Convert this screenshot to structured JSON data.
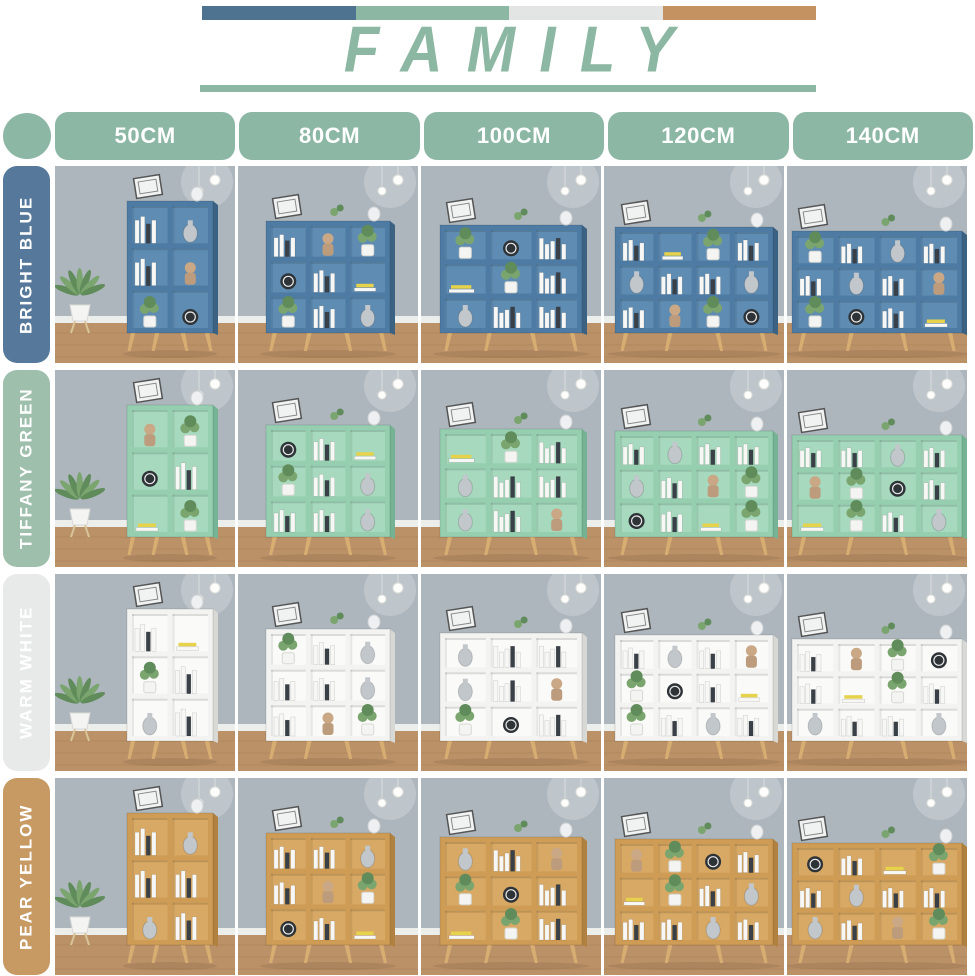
{
  "banner": {
    "title": "FAMILY",
    "title_color": "#8cb7a2",
    "underline_color": "#8cb7a2",
    "bar_colors": [
      "#4d7390",
      "#8cb7a2",
      "#e3e5e4",
      "#c49160"
    ]
  },
  "size_header": {
    "dot_color": "#8cb7a4",
    "pill_color": "#8cb7a4",
    "sizes": [
      "50CM",
      "80CM",
      "100CM",
      "120CM",
      "140CM"
    ]
  },
  "rows": [
    {
      "id": "bright-blue",
      "label": "BRIGHT BLUE",
      "label_bg": "#56789b",
      "shelf": "#4e7ba3",
      "shelf_dark": "#3c6283",
      "interior": "#5f8cb2"
    },
    {
      "id": "tiffany-green",
      "label": "TIFFANY GREEN",
      "label_bg": "#9dbfab",
      "shelf": "#96cfb0",
      "shelf_dark": "#76b394",
      "interior": "#a6d9bd"
    },
    {
      "id": "warm-white",
      "label": "WARM WHITE",
      "label_bg": "#e8eae9",
      "shelf": "#f3f3f1",
      "shelf_dark": "#d8d8d4",
      "interior": "#fafaf8"
    },
    {
      "id": "pear-yellow",
      "label": "PEAR YELLOW",
      "label_bg": "#c79a64",
      "shelf": "#cf9c55",
      "shelf_dark": "#b1823f",
      "interior": "#d8a964"
    }
  ],
  "scene": {
    "wall": "#adb6bd",
    "floor": "#bb9168",
    "floor_line": "#a67e55",
    "baseboard": "#eceeec",
    "leg": "#d7ad72",
    "plant_green": "#7ba56f",
    "plant_dark": "#5f8c5a",
    "pot": "#f4f4f2",
    "book_white": "#f7f7f5",
    "book_dark": "#3a4047",
    "accent_yellow": "#e6d24b",
    "vase_gray": "#c2c7cc",
    "doll_tan": "#bd9c7d"
  }
}
